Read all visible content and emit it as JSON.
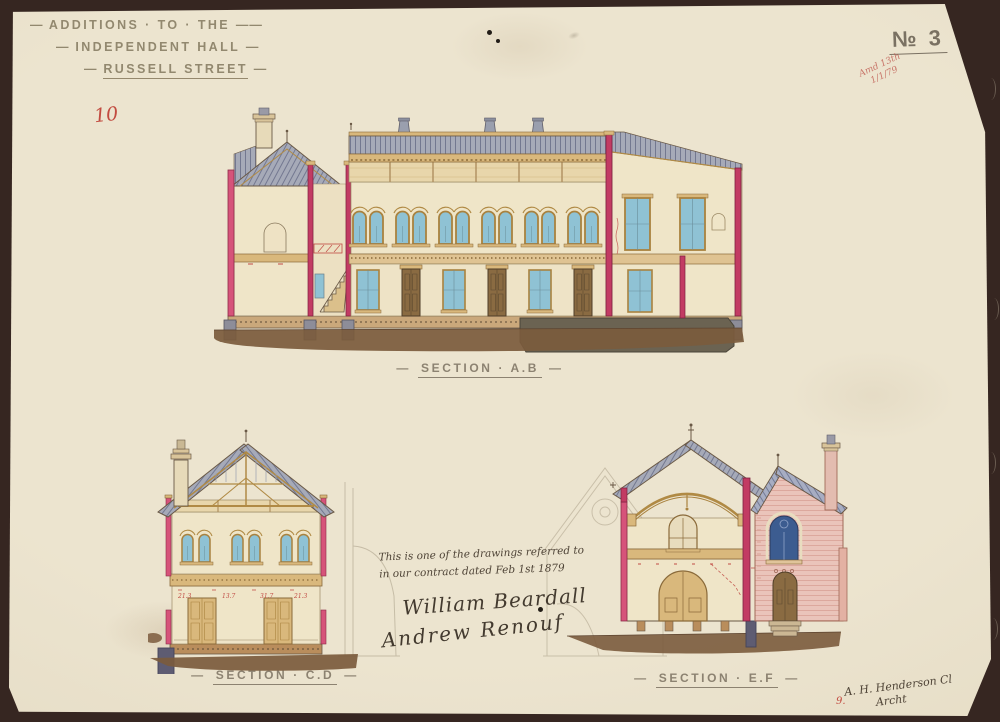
{
  "palette": {
    "paper": "#e9e1cc",
    "mount_brown": "#362621",
    "ink_sepia": "#6a5946",
    "cut_pink": "#d6537a",
    "cut_crimson": "#c23b63",
    "roof_slate": "#a6aab8",
    "roof_hatch": "#737890",
    "wing_slate_blue": "#a7adc2",
    "timber_tan": "#d9b87c",
    "timber_dark": "#a9823f",
    "wall_cream": "#efe5c8",
    "frieze_tan": "#e8d6ab",
    "glass_blue": "#8fc2d4",
    "glass_dark_blue": "#3c5c90",
    "door_brown": "#8a6b42",
    "ground_brown": "#7b5b3d",
    "foundation_olive": "#6b6352",
    "pier_gray": "#8d8d99",
    "brick_pink": "#eac4ba",
    "red_ink": "#c04a43"
  },
  "title": {
    "lines": [
      {
        "pre": "—",
        "text": "ADDITIONS · TO · THE",
        "post": "——"
      },
      {
        "pre": "—",
        "text": "INDEPENDENT HALL",
        "post": "—"
      },
      {
        "pre": "—",
        "text": "RUSSELL STREET",
        "post": "—"
      }
    ]
  },
  "sheet_no": {
    "label": "№ 3"
  },
  "annotations": {
    "folio": "10",
    "stamp_line1": "Amd 13th",
    "stamp_line2": "1/1/79",
    "corner": "9."
  },
  "figures": {
    "ab": {
      "caption": {
        "pre": "—",
        "text": "SECTION · A.B",
        "post": "—"
      }
    },
    "cd": {
      "caption": {
        "pre": "—",
        "text": "SECTION · C.D",
        "post": "—"
      },
      "red_dims": [
        "21.3",
        "13.7",
        "31.7",
        "21.3"
      ]
    },
    "ef": {
      "caption": {
        "pre": "—",
        "text": "SECTION · E.F",
        "post": "—"
      }
    }
  },
  "note": {
    "line1": "This is one of the drawings referred to",
    "line2": "in our contract dated Feb 1st 1879",
    "signature1": "William Beardall",
    "signature2": "Andrew Renouf"
  },
  "credit": {
    "line1": "A. H. Henderson Cl",
    "line2": "Archt"
  }
}
